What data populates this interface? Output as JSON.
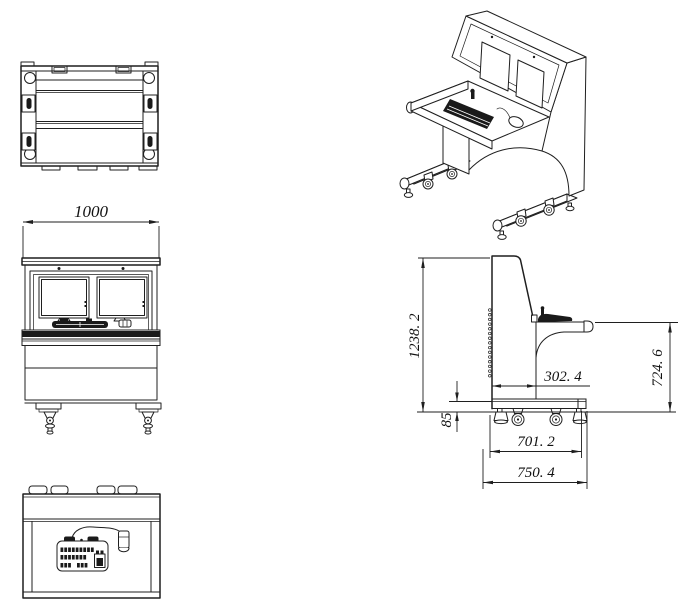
{
  "dimensions": {
    "front_width": "1000",
    "side_total_height": "1238. 2",
    "side_base_height": "85",
    "side_knee_depth": "302. 4",
    "side_worktop_height": "724. 6",
    "side_base_depth": "701. 2",
    "side_total_depth": "750. 4"
  },
  "style": {
    "background": "#ffffff",
    "line_color": "#1f1f1f",
    "dark_fill": "#1a1a1a"
  }
}
